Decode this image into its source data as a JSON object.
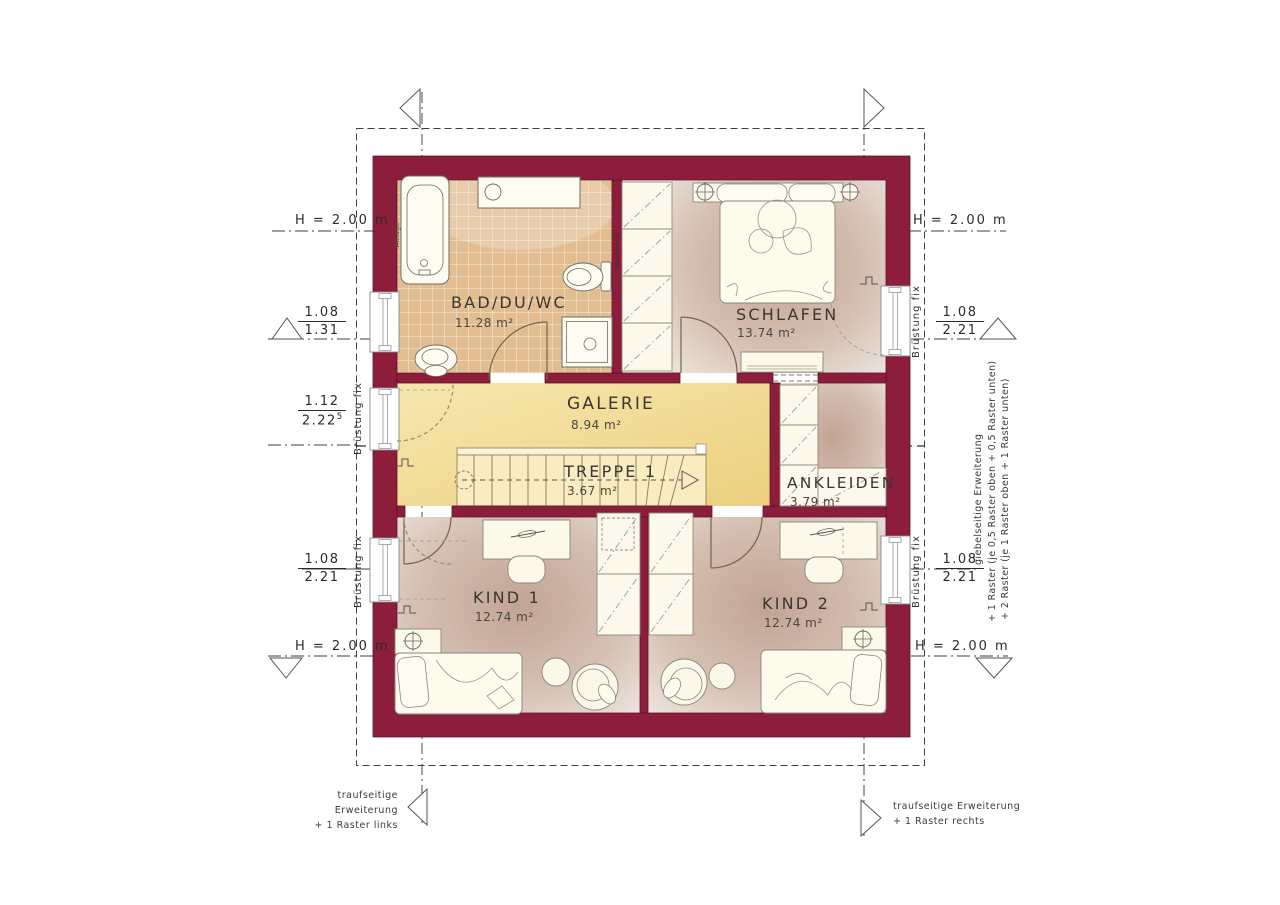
{
  "plan": {
    "rooms": [
      {
        "id": "bad",
        "name": "BAD/DU/WC",
        "area": "11.28 m²"
      },
      {
        "id": "schlafen",
        "name": "SCHLAFEN",
        "area": "13.74 m²"
      },
      {
        "id": "galerie",
        "name": "GALERIE",
        "area": "8.94 m²"
      },
      {
        "id": "treppe",
        "name": "TREPPE 1",
        "area": "3.67 m²"
      },
      {
        "id": "ankleiden",
        "name": "ANKLEIDEN",
        "area": "3.79 m²"
      },
      {
        "id": "kind1",
        "name": "KIND 1",
        "area": "12.74 m²"
      },
      {
        "id": "kind2",
        "name": "KIND 2",
        "area": "12.74 m²"
      }
    ],
    "h_labels": {
      "top_left": "H = 2.00 m",
      "top_right": "H = 2.00 m",
      "bottom_left": "H = 2.00 m",
      "bottom_right": "H = 2.00 m"
    },
    "dimensions": {
      "left_top": {
        "num": "1.08",
        "den": "1.31"
      },
      "left_middle": {
        "num": "1.12",
        "den": "2.22",
        "den_sup": "5"
      },
      "left_bottom": {
        "num": "1.08",
        "den": "2.21"
      },
      "right_top": {
        "num": "1.08",
        "den": "2.21"
      },
      "right_bottom": {
        "num": "1.08",
        "den": "2.21"
      }
    },
    "window_notes": {
      "left_galerie": "Brüstung fix",
      "left_kind1": "Brüstung fix",
      "right_schlafen": "Brüstung fix",
      "right_kind2": "Brüstung fix"
    },
    "wall_notes": {
      "ablage": "Ablage",
      "raumhoch": "raumhoch"
    },
    "extension_notes": {
      "right_column": [
        "giebelseitige Erweiterung",
        "+ 1 Raster (je 0,5 Raster oben + 0,5 Raster unten)",
        "+ 2 Raster (je 1 Raster oben + 1 Raster unten)"
      ],
      "bottom_left": [
        "traufseitige Erweiterung",
        "+ 1 Raster links"
      ],
      "bottom_right": [
        "traufseitige Erweiterung",
        "+ 1 Raster rechts"
      ]
    },
    "colors": {
      "wall": "#8c1e3b",
      "galerie_floor": "#f0d98e",
      "stair_floor": "#f8ecc0",
      "room_floor_center": "#c2a395",
      "room_floor_edge": "#eee6df",
      "tile_floor": "#e2bd92",
      "furniture_fill": "#fcf8ec",
      "annotation": "#3f3b36"
    }
  }
}
